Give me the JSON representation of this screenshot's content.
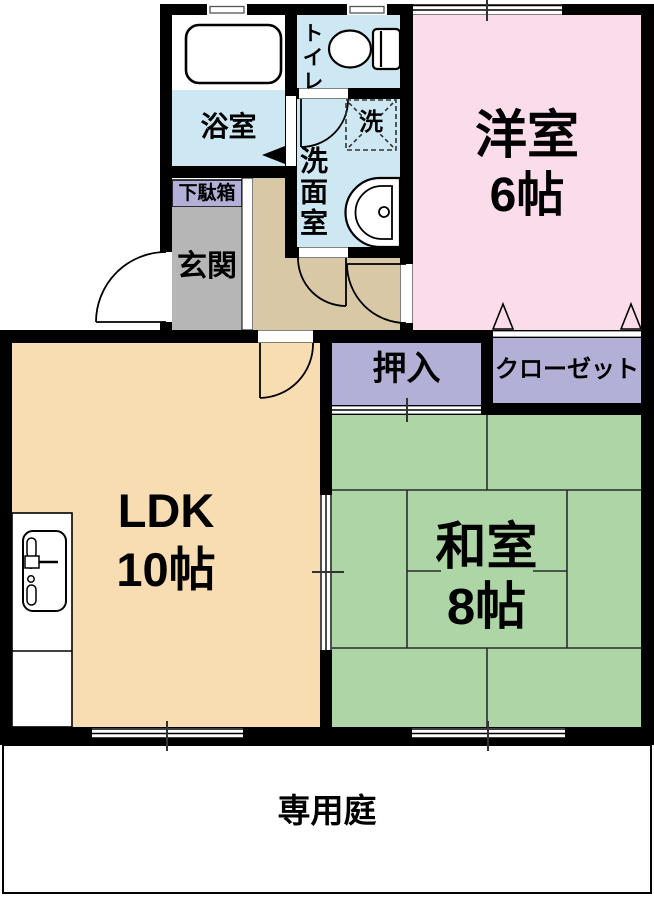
{
  "plan": {
    "rooms": {
      "western_room": {
        "label": "洋室",
        "size": "6帖"
      },
      "japanese_room": {
        "label": "和室",
        "size": "8帖"
      },
      "ldk": {
        "label": "LDK",
        "size": "10帖"
      },
      "bathroom": {
        "label": "浴室"
      },
      "toilet": {
        "label": "トイレ"
      },
      "washroom": {
        "label": "洗面室"
      },
      "laundry_space": {
        "label": "洗"
      },
      "entrance": {
        "label": "玄関"
      },
      "shoe_cabinet": {
        "label": "下駄箱"
      },
      "oshiire": {
        "label": "押入"
      },
      "closet": {
        "label": "クローゼット"
      },
      "private_garden": {
        "label": "専用庭"
      }
    },
    "colors": {
      "wall": "#000000",
      "water_blue": "#cde8f3",
      "pink": "#fbdcea",
      "lavender": "#b2b0d6",
      "tatami_green": "#aed5a5",
      "ldk_tan": "#f8dcb2",
      "hall_tan": "#d9c8a5",
      "entrance_gray": "#b6b6b6",
      "floor_white": "#ffffff"
    },
    "icons": {
      "bathtub": "bathtub-icon",
      "toilet": "toilet-icon",
      "washbasin": "washbasin-icon",
      "kitchen_sink": "kitchen-sink-icon",
      "washing_machine_pan": "washing-machine-pan-icon"
    }
  }
}
